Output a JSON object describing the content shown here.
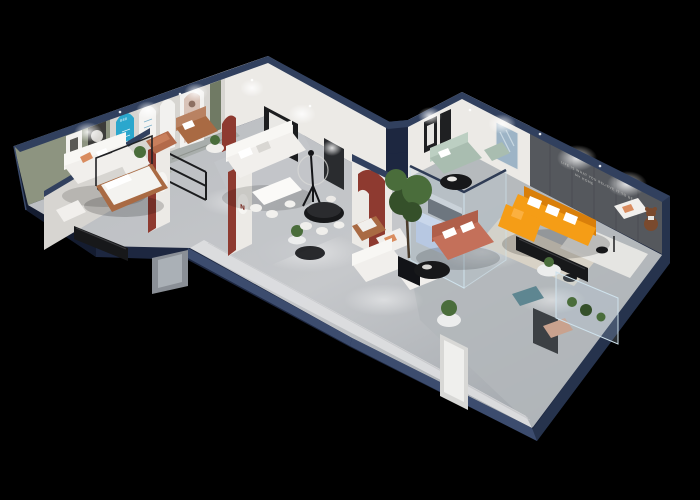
{
  "scene": {
    "description": "3D isometric cutaway render of a furniture showroom floor plan on a black background",
    "background": "#000000"
  },
  "texts": {
    "wall_tagline_line1": "LIFE IS WHAT YOU BELIEVE IT TO BE",
    "wall_tagline_line2": "MY HOME",
    "arch_digits": "888",
    "emblem_letter_1": "N",
    "emblem_letter_2": "N"
  },
  "palette": {
    "bg": "#000000",
    "navyFace": "#1d2740",
    "navyFaceDark": "#141c30",
    "navyFaceLight": "#26334d",
    "navyCap": "#31405e",
    "navyCapHi": "#3c4c6e",
    "wallWhite": "#eceae6",
    "wallShadow": "#d7d5d1",
    "wallSage": "#8d9480",
    "wallOlive": "#707a64",
    "wallCharcoal": "#55585d",
    "panelRed": "#8e3a30",
    "archCyan": "#2ba7cd",
    "tile": "#dcdddf",
    "floorA": "#c4c6c9",
    "floorB": "#94999f",
    "sofaWhite": "#f1efec",
    "sofaWhiteBack": "#f8f7f4",
    "sofaSage": "#a9bdb0",
    "sofaPeriwinkle": "#b6c6e2",
    "sofaPeriwinkleBack": "#cdd9ee",
    "sofaOrange": "#f59d16",
    "sofaOrangeDark": "#d97f0a",
    "sofaCoral": "#c4705a",
    "sofaCoralDark": "#b05f4a",
    "sofaCognac": "#a96a43",
    "sofaCognacLight": "#b98262",
    "sofaTan": "#c9a28e",
    "copper": "#b36a4a",
    "benchTeal": "#5e8691",
    "blackFurniture": "#17181a",
    "wood": "#b3a795",
    "rugGray": "#a9aeac",
    "rugBeige": "#d8d2c6",
    "rugSage": "#aab1a6",
    "rugWhite": "#e9e8e5",
    "plant": "#4a6d3b",
    "plantDark": "#35502a",
    "glassFill": "rgba(185,210,228,0.22)",
    "glassEdge": "#cfe2ec",
    "bear": "#7a4a2e"
  }
}
